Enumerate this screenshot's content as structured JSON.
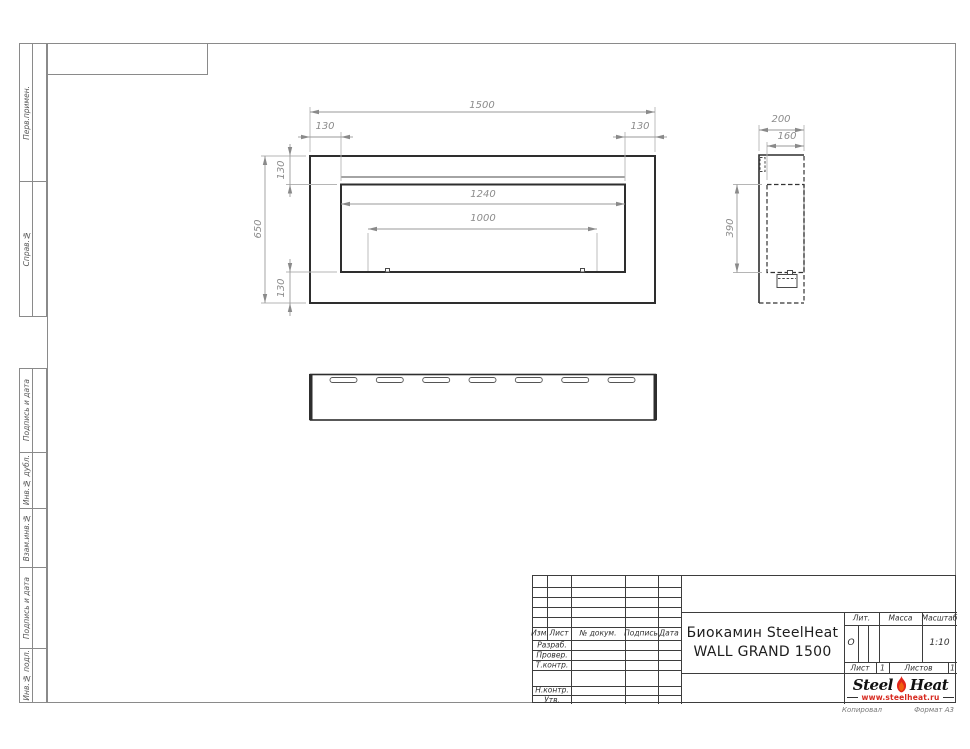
{
  "frame": {
    "copied_label": "Копировал",
    "format_label": "Формат А3"
  },
  "left_strip": {
    "items": [
      "Перв.примен.",
      "Справ.№",
      "Подпись и дата",
      "Инв.№ дубл.",
      "Взам.инв.№",
      "Подпись и дата",
      "Инв.№ подл."
    ]
  },
  "drawing": {
    "front_view": {
      "overall_width": "1500",
      "left_margin": "130",
      "right_margin": "130",
      "overall_height": "650",
      "top_margin": "130",
      "bottom_margin": "130",
      "opening_width": "1240",
      "burner_width": "1000"
    },
    "side_view": {
      "depth": "200",
      "inner_depth": "160",
      "opening_height": "390"
    },
    "bottom_view": {
      "slot_count": 7
    }
  },
  "title_block": {
    "revision_header": {
      "izm": "Изм.",
      "list": "Лист",
      "doc": "№ докум.",
      "sign": "Подпись",
      "date": "Дата"
    },
    "signature_rows": [
      "Разраб.",
      "Провер.",
      "Т.контр.",
      "Н.контр.",
      "Утв."
    ],
    "title_line1": "Биокамин SteelHeat",
    "title_line2": "WALL GRAND 1500",
    "lit_label": "Лит.",
    "lit_value": "О",
    "mass_label": "Масса",
    "scale_label": "Масштаб",
    "scale_value": "1:10",
    "sheet_label": "Лист",
    "sheet_number": "1",
    "sheets_label": "Листов",
    "sheets_total": "1",
    "logo": {
      "name_part1": "Steel",
      "name_part2": "Heat",
      "website": "www.steelheat.ru",
      "flame_color": "#e2261b",
      "accent_color": "#d6281e"
    }
  }
}
